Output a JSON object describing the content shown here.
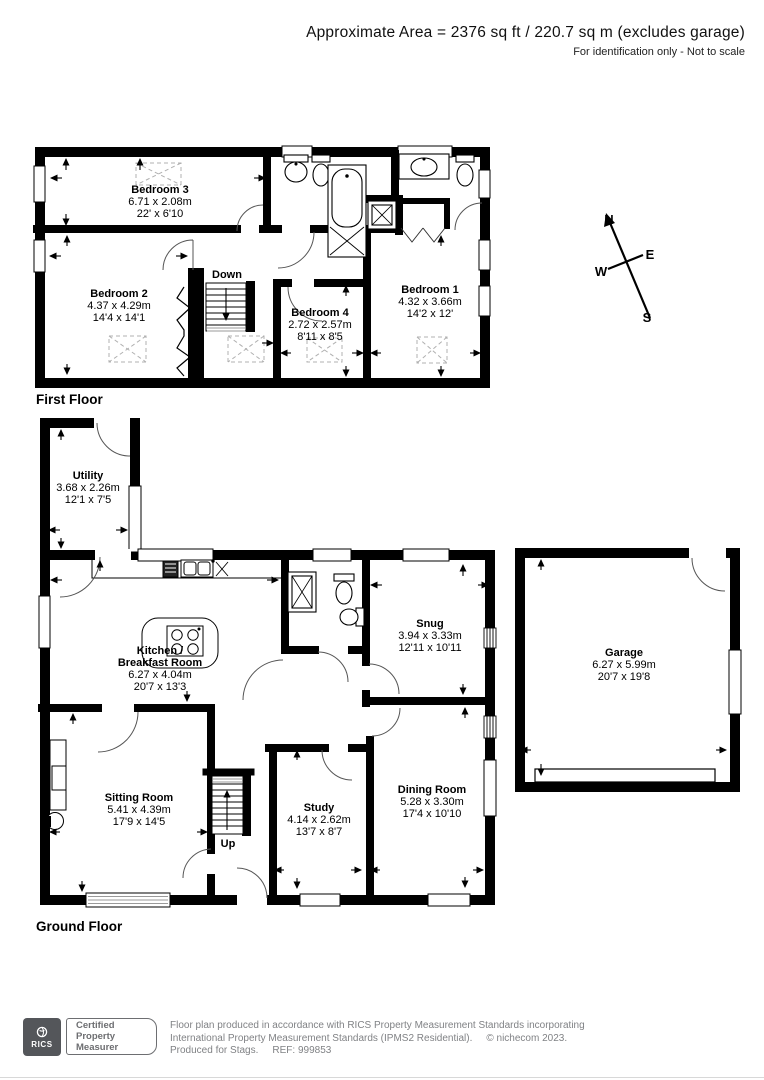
{
  "header": {
    "title": "Approximate Area = 2376 sq ft / 220.7 sq m (excludes garage)",
    "disclaimer": "For identification only - Not to scale"
  },
  "compass": {
    "north": "N",
    "east": "E",
    "south": "S",
    "west": "W"
  },
  "colors": {
    "wall": "#000000",
    "paper": "#ffffff",
    "footer_gray": "#808285",
    "badge_gray": "#54565a",
    "dashed_marker": "#b0b0b0"
  },
  "floors": {
    "first": {
      "label": "First Floor",
      "stairs": "Down",
      "rooms": {
        "bedroom3": {
          "name": "Bedroom 3",
          "metric": "6.71 x 2.08m",
          "imperial": "22' x 6'10"
        },
        "bedroom2": {
          "name": "Bedroom 2",
          "metric": "4.37 x 4.29m",
          "imperial": "14'4 x 14'1"
        },
        "bedroom4": {
          "name": "Bedroom 4",
          "metric": "2.72 x 2.57m",
          "imperial": "8'11 x 8'5"
        },
        "bedroom1": {
          "name": "Bedroom 1",
          "metric": "4.32 x 3.66m",
          "imperial": "14'2 x 12'"
        }
      }
    },
    "ground": {
      "label": "Ground Floor",
      "stairs": "Up",
      "rooms": {
        "utility": {
          "name": "Utility",
          "metric": "3.68 x 2.26m",
          "imperial": "12'1 x 7'5"
        },
        "kitchen": {
          "name_line1": "Kitchen /",
          "name_line2": "Breakfast Room",
          "metric": "6.27 x 4.04m",
          "imperial": "20'7 x 13'3"
        },
        "snug": {
          "name": "Snug",
          "metric": "3.94 x 3.33m",
          "imperial": "12'11 x 10'11"
        },
        "garage": {
          "name": "Garage",
          "metric": "6.27 x 5.99m",
          "imperial": "20'7 x 19'8"
        },
        "sitting": {
          "name": "Sitting Room",
          "metric": "5.41 x 4.39m",
          "imperial": "17'9 x 14'5"
        },
        "study": {
          "name": "Study",
          "metric": "4.14 x 2.62m",
          "imperial": "13'7 x 8'7"
        },
        "dining": {
          "name": "Dining Room",
          "metric": "5.28 x 3.30m",
          "imperial": "17'4 x 10'10"
        }
      }
    }
  },
  "footer": {
    "rics_label": "RICS",
    "badge_lines": [
      "Certified",
      "Property",
      "Measurer"
    ],
    "line1": "Floor plan produced in accordance with RICS Property Measurement Standards incorporating",
    "line2": "International Property Measurement Standards (IPMS2 Residential).",
    "copyright": "© nichecom 2023.",
    "line3": "Produced for Stags.",
    "ref": "REF: 999853"
  }
}
